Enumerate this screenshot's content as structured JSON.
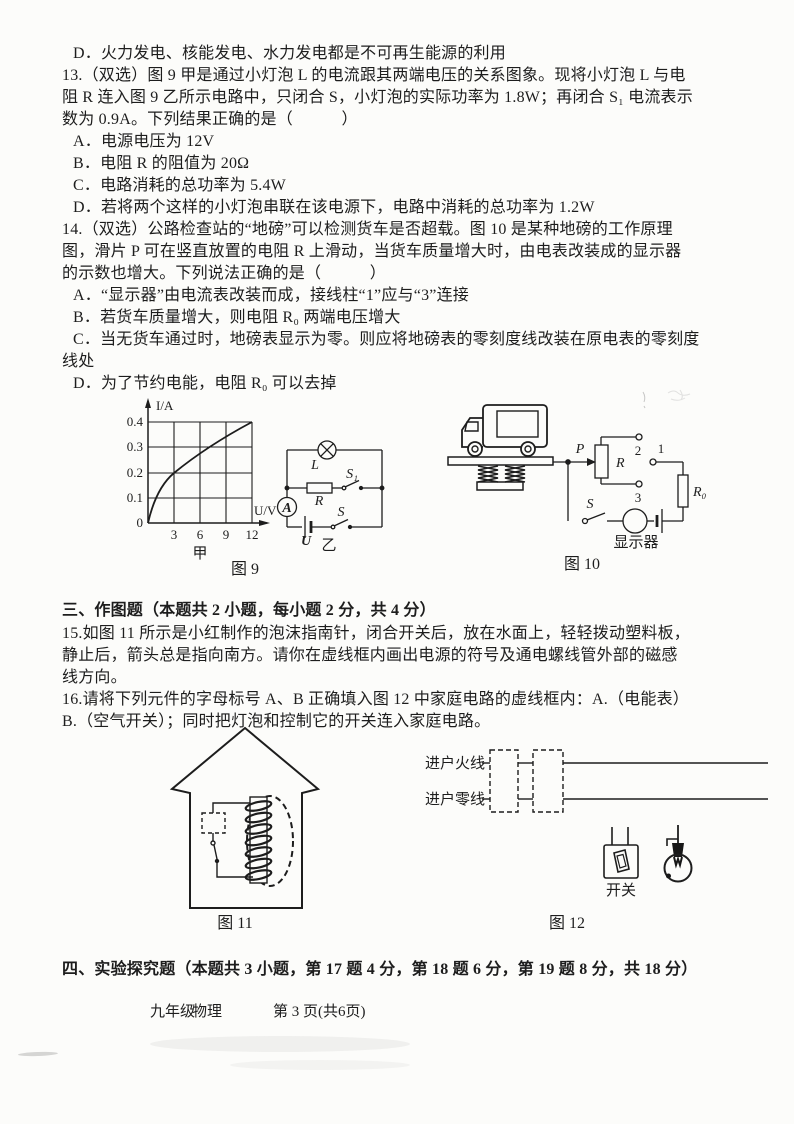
{
  "colors": {
    "paper": "#fcfcfa",
    "ink": "#1d1d1d"
  },
  "text": {
    "q12_option_d": "D．火力发电、核能发电、水力发电都是不可再生能源的利用",
    "q13_lines": [
      "13.（双选）图 9 甲是通过小灯泡 L 的电流跟其两端电压的关系图象。现将小灯泡 L 与电",
      "阻 R 连入图 9 乙所示电路中，只闭合 S，小灯泡的实际功率为 1.8W；再闭合 S₁ 电流表示",
      "数为 0.9A。下列结果正确的是（　　　）",
      "A．电源电压为 12V",
      "B．电阻 R 的阻值为 20Ω",
      "C．电路消耗的总功率为 5.4W",
      "D．若将两个这样的小灯泡串联在该电源下，电路中消耗的总功率为 1.2W"
    ],
    "q14_lines": [
      "14.（双选）公路检查站的“地磅”可以检测货车是否超载。图 10 是某种地磅的工作原理",
      "图，滑片 P 可在竖直放置的电阻 R 上滑动，当货车质量增大时，由电表改装成的显示器",
      "的示数也增大。下列说法正确的是（　　　）",
      "A．“显示器”由电流表改装而成，接线柱“1”应与“3”连接",
      "B．若货车质量增大，则电阻 R₀ 两端电压增大",
      "C．当无货车通过时，地磅表显示为零。则应将地磅表的零刻度线改装在原电表的零刻度",
      "线处",
      "D．为了节约电能，电阻 R₀ 可以去掉"
    ],
    "section3_title": "三、作图题（本题共 2 小题，每小题 2 分，共 4 分）",
    "q15_lines": [
      "15.如图 11 所示是小红制作的泡沫指南针，闭合开关后，放在水面上，轻轻拨动塑料板，",
      "静止后，箭头总是指向南方。请你在虚线框内画出电源的符号及通电螺线管外部的磁感",
      "线方向。"
    ],
    "q16_lines": [
      "16.请将下列元件的字母标号 A、B 正确填入图 12 中家庭电路的虚线框内：A.（电能表）",
      "B.（空气开关）；同时把灯泡和控制它的开关连入家庭电路。"
    ],
    "section4_title": "四、实验探究题（本题共 3 小题，第 17 题 4 分，第 18 题 6 分，第 19 题 8 分，共 18 分）"
  },
  "fig9": {
    "caption": "图 9",
    "graph": {
      "y_axis": "I/A",
      "x_axis": "U/V",
      "y_ticks": [
        "0.4",
        "0.3",
        "0.2",
        "0.1",
        "0"
      ],
      "x_ticks": [
        "3",
        "6",
        "9",
        "12"
      ],
      "label": "甲"
    },
    "circuit": {
      "lamp": "L",
      "resistor": "R",
      "switch1": "S₁",
      "switch": "S",
      "ammeter": "A",
      "battery": "U",
      "label": "乙"
    }
  },
  "fig10": {
    "caption": "图 10",
    "wiper": "P",
    "resistor": "R",
    "t2": "2",
    "t1": "1",
    "t3": "3",
    "r0": "R₀",
    "switch": "S",
    "display": "显示器"
  },
  "fig11": {
    "caption": "图 11"
  },
  "fig12": {
    "caption": "图 12",
    "live": "进户火线",
    "neutral": "进户零线",
    "switch": "开关"
  },
  "footer": {
    "grade": "九年级",
    "subject": "物理",
    "page_info": "第 3 页(共6页)"
  },
  "chart_data": {
    "type": "line",
    "title": "图9甲 小灯泡I-U关系图象",
    "xlabel": "U/V",
    "ylabel": "I/A",
    "x": [
      0,
      3,
      6,
      9,
      12
    ],
    "y": [
      0,
      0.2,
      0.3,
      0.36,
      0.4
    ],
    "xlim": [
      0,
      12
    ],
    "ylim": [
      0,
      0.4
    ],
    "x_ticks": [
      3,
      6,
      9,
      12
    ],
    "y_ticks": [
      0.1,
      0.2,
      0.3,
      0.4
    ],
    "grid": true,
    "legend": "none",
    "sub_label": "甲"
  }
}
